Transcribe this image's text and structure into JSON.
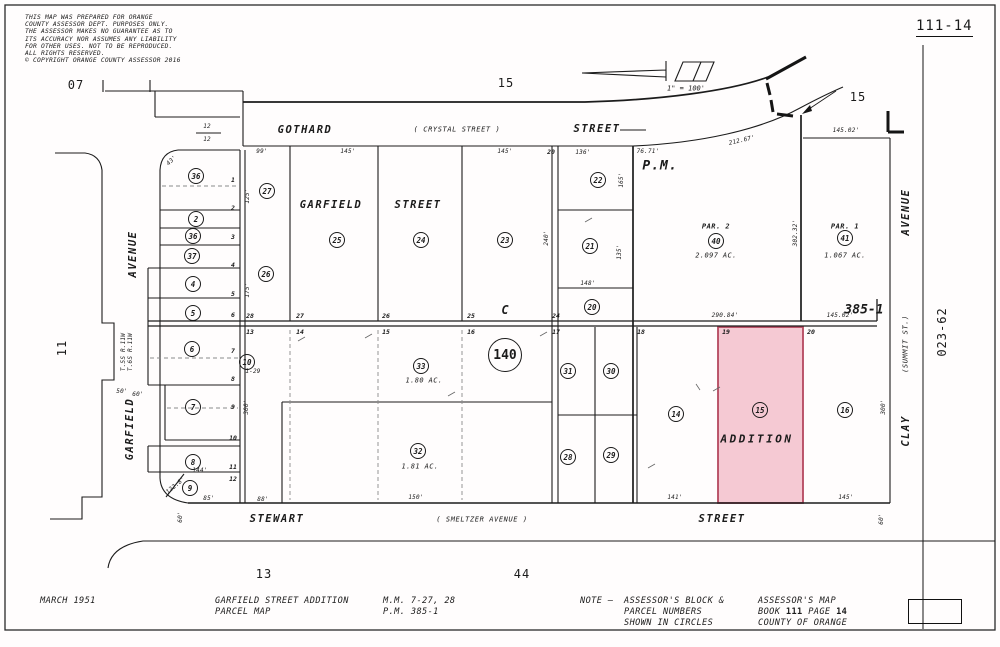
{
  "page": {
    "map_ref": "111-14",
    "disclaimer_lines": [
      "THIS MAP WAS PREPARED FOR ORANGE",
      "COUNTY ASSESSOR DEPT. PURPOSES ONLY.",
      "THE ASSESSOR MAKES NO GUARANTEE AS TO",
      "ITS ACCURACY NOR ASSUMES ANY LIABILITY",
      "FOR OTHER USES.  NOT TO BE REPRODUCED.",
      "ALL RIGHTS RESERVED.",
      "© COPYRIGHT ORANGE COUNTY ASSESSOR 2016"
    ]
  },
  "footer": {
    "date": "MARCH 1951",
    "title_line1": "GARFIELD STREET ADDITION",
    "title_line2": "PARCEL MAP",
    "ref_line1": "M.M. 7-27, 28",
    "ref_line2": "P.M. 385-1",
    "note_prefix": "NOTE —",
    "note_line1": "ASSESSOR'S BLOCK &",
    "note_line2": "PARCEL NUMBERS",
    "note_line3": "SHOWN IN CIRCLES",
    "assessor_line1": "ASSESSOR'S MAP",
    "book_label": "BOOK",
    "book_number": "111",
    "page_label": "PAGE",
    "page_number": "14",
    "assessor_line3": "COUNTY OF ORANGE"
  },
  "map": {
    "highlight": {
      "parcel": "15",
      "fill": "#f5c9d3",
      "stroke": "#b5485e"
    },
    "scale_note": "1\" = 100'",
    "labels": [
      {
        "t": "GOTHARD",
        "x": 305,
        "y": 130,
        "k": "street"
      },
      {
        "t": "( CRYSTAL STREET )",
        "x": 457,
        "y": 130,
        "k": "ssub"
      },
      {
        "t": "STREET",
        "x": 597,
        "y": 129,
        "k": "street"
      },
      {
        "t": "GARFIELD",
        "x": 331,
        "y": 205,
        "k": "street"
      },
      {
        "t": "STREET",
        "x": 418,
        "y": 205,
        "k": "street"
      },
      {
        "t": "AVENUE",
        "x": 133,
        "y": 254,
        "k": "street",
        "r": -90
      },
      {
        "t": "GARFIELD",
        "x": 130,
        "y": 429,
        "k": "street",
        "r": -90
      },
      {
        "t": "STEWART",
        "x": 277,
        "y": 519,
        "k": "street"
      },
      {
        "t": "( SMELTZER AVENUE )",
        "x": 482,
        "y": 520,
        "k": "ssub"
      },
      {
        "t": "STREET",
        "x": 722,
        "y": 519,
        "k": "street"
      },
      {
        "t": "AVENUE",
        "x": 906,
        "y": 212,
        "k": "street",
        "r": -90
      },
      {
        "t": "(SUMMIT ST.)",
        "x": 906,
        "y": 344,
        "k": "ssub",
        "r": -90
      },
      {
        "t": "CLAY",
        "x": 906,
        "y": 431,
        "k": "street",
        "r": -90
      },
      {
        "t": "P.M.",
        "x": 660,
        "y": 166,
        "k": "pm"
      },
      {
        "t": "C",
        "x": 505,
        "y": 310,
        "k": "blk"
      },
      {
        "t": "ADDITION",
        "x": 757,
        "y": 439,
        "k": "add"
      },
      {
        "t": "385-1",
        "x": 864,
        "y": 310,
        "k": "ref"
      },
      {
        "t": "PAR. 2",
        "x": 716,
        "y": 227,
        "k": "par"
      },
      {
        "t": "2.097 AC.",
        "x": 716,
        "y": 256,
        "k": "acr"
      },
      {
        "t": "PAR. 1",
        "x": 845,
        "y": 227,
        "k": "par"
      },
      {
        "t": "1.067 AC.",
        "x": 845,
        "y": 256,
        "k": "acr"
      },
      {
        "t": "1.80 AC.",
        "x": 424,
        "y": 381,
        "k": "acr"
      },
      {
        "t": "1.81 AC.",
        "x": 420,
        "y": 467,
        "k": "acr"
      },
      {
        "t": "1\" = 100'",
        "x": 686,
        "y": 89,
        "k": "scale"
      },
      {
        "t": "07",
        "x": 76,
        "y": 85,
        "k": "page"
      },
      {
        "t": "15",
        "x": 506,
        "y": 83,
        "k": "page"
      },
      {
        "t": "15",
        "x": 858,
        "y": 97,
        "k": "page"
      },
      {
        "t": "11",
        "x": 62,
        "y": 348,
        "k": "page",
        "r": -90
      },
      {
        "t": "13",
        "x": 264,
        "y": 574,
        "k": "page"
      },
      {
        "t": "44",
        "x": 522,
        "y": 574,
        "k": "page"
      },
      {
        "t": "023-62",
        "x": 942,
        "y": 332,
        "k": "page",
        "r": -90
      },
      {
        "t": "28",
        "x": 250,
        "y": 316,
        "k": "lot"
      },
      {
        "t": "27",
        "x": 300,
        "y": 316,
        "k": "lot"
      },
      {
        "t": "26",
        "x": 386,
        "y": 316,
        "k": "lot"
      },
      {
        "t": "25",
        "x": 471,
        "y": 316,
        "k": "lot"
      },
      {
        "t": "24",
        "x": 556,
        "y": 316,
        "k": "lot"
      },
      {
        "t": "13",
        "x": 250,
        "y": 332,
        "k": "lot"
      },
      {
        "t": "14",
        "x": 300,
        "y": 332,
        "k": "lot"
      },
      {
        "t": "15",
        "x": 386,
        "y": 332,
        "k": "lot"
      },
      {
        "t": "16",
        "x": 471,
        "y": 332,
        "k": "lot"
      },
      {
        "t": "17",
        "x": 556,
        "y": 332,
        "k": "lot"
      },
      {
        "t": "18",
        "x": 641,
        "y": 332,
        "k": "lot"
      },
      {
        "t": "19",
        "x": 726,
        "y": 332,
        "k": "lot"
      },
      {
        "t": "20",
        "x": 811,
        "y": 332,
        "k": "lot"
      },
      {
        "t": "1",
        "x": 233,
        "y": 180,
        "k": "lot"
      },
      {
        "t": "2",
        "x": 233,
        "y": 208,
        "k": "lot"
      },
      {
        "t": "3",
        "x": 233,
        "y": 237,
        "k": "lot"
      },
      {
        "t": "4",
        "x": 233,
        "y": 265,
        "k": "lot"
      },
      {
        "t": "5",
        "x": 233,
        "y": 294,
        "k": "lot"
      },
      {
        "t": "6",
        "x": 233,
        "y": 315,
        "k": "lot"
      },
      {
        "t": "7",
        "x": 233,
        "y": 351,
        "k": "lot"
      },
      {
        "t": "8",
        "x": 233,
        "y": 379,
        "k": "lot"
      },
      {
        "t": "9",
        "x": 233,
        "y": 407,
        "k": "lot"
      },
      {
        "t": "10",
        "x": 233,
        "y": 438,
        "k": "lot"
      },
      {
        "t": "11",
        "x": 233,
        "y": 467,
        "k": "lot"
      },
      {
        "t": "12",
        "x": 233,
        "y": 479,
        "k": "lot"
      },
      {
        "t": "20",
        "x": 551,
        "y": 152,
        "k": "lot"
      },
      {
        "t": "99'",
        "x": 262,
        "y": 152,
        "k": "dim"
      },
      {
        "t": "145'",
        "x": 348,
        "y": 152,
        "k": "dim"
      },
      {
        "t": "145'",
        "x": 505,
        "y": 152,
        "k": "dim"
      },
      {
        "t": "136'",
        "x": 583,
        "y": 153,
        "k": "dim"
      },
      {
        "t": "43'",
        "x": 172,
        "y": 161,
        "k": "dim",
        "r": -45
      },
      {
        "t": "125'",
        "x": 248,
        "y": 196,
        "k": "dim",
        "r": -90
      },
      {
        "t": "175'",
        "x": 248,
        "y": 290,
        "k": "dim",
        "r": -90
      },
      {
        "t": "300'",
        "x": 247,
        "y": 407,
        "k": "dim",
        "r": -90
      },
      {
        "t": "50'",
        "x": 122,
        "y": 392,
        "k": "dim"
      },
      {
        "t": "60'",
        "x": 138,
        "y": 395,
        "k": "dim"
      },
      {
        "t": "T.5S R.11W",
        "x": 124,
        "y": 352,
        "k": "dim",
        "r": -90
      },
      {
        "t": "T.6S R.11W",
        "x": 131,
        "y": 352,
        "k": "dim",
        "r": -90
      },
      {
        "t": "144'",
        "x": 200,
        "y": 471,
        "k": "dim"
      },
      {
        "t": "85'",
        "x": 209,
        "y": 499,
        "k": "dim"
      },
      {
        "t": "88'",
        "x": 263,
        "y": 500,
        "k": "dim"
      },
      {
        "t": "122.8'",
        "x": 176,
        "y": 486,
        "k": "dim",
        "r": -40
      },
      {
        "t": "60'",
        "x": 181,
        "y": 517,
        "k": "dim",
        "r": -90
      },
      {
        "t": "1-29",
        "x": 253,
        "y": 372,
        "k": "dim"
      },
      {
        "t": "148'",
        "x": 588,
        "y": 284,
        "k": "dim"
      },
      {
        "t": "240'",
        "x": 547,
        "y": 238,
        "k": "dim",
        "r": -90
      },
      {
        "t": "165'",
        "x": 622,
        "y": 180,
        "k": "dim",
        "r": -90
      },
      {
        "t": "135'",
        "x": 620,
        "y": 252,
        "k": "dim",
        "r": -90
      },
      {
        "t": "76.71'",
        "x": 648,
        "y": 152,
        "k": "dim"
      },
      {
        "t": "212.67'",
        "x": 742,
        "y": 141,
        "k": "dim",
        "r": -13
      },
      {
        "t": "145.02'",
        "x": 846,
        "y": 131,
        "k": "dim"
      },
      {
        "t": "290.84'",
        "x": 725,
        "y": 316,
        "k": "dim"
      },
      {
        "t": "145.02'",
        "x": 840,
        "y": 316,
        "k": "dim"
      },
      {
        "t": "302.32'",
        "x": 796,
        "y": 233,
        "k": "dim",
        "r": -90
      },
      {
        "t": "300'",
        "x": 884,
        "y": 407,
        "k": "dim",
        "r": -90
      },
      {
        "t": "150'",
        "x": 416,
        "y": 498,
        "k": "dim"
      },
      {
        "t": "141'",
        "x": 675,
        "y": 498,
        "k": "dim"
      },
      {
        "t": "145'",
        "x": 846,
        "y": 498,
        "k": "dim"
      },
      {
        "t": "60'",
        "x": 882,
        "y": 519,
        "k": "dim",
        "r": -90
      },
      {
        "t": "12",
        "x": 207,
        "y": 127,
        "k": "dim"
      },
      {
        "t": "12",
        "x": 207,
        "y": 140,
        "k": "dim"
      }
    ],
    "parcel_circles": [
      {
        "n": "36",
        "x": 196,
        "y": 176
      },
      {
        "n": "2",
        "x": 196,
        "y": 219
      },
      {
        "n": "36",
        "x": 193,
        "y": 236
      },
      {
        "n": "37",
        "x": 192,
        "y": 256
      },
      {
        "n": "4",
        "x": 193,
        "y": 284
      },
      {
        "n": "5",
        "x": 193,
        "y": 313
      },
      {
        "n": "6",
        "x": 192,
        "y": 349
      },
      {
        "n": "10",
        "x": 247,
        "y": 362
      },
      {
        "n": "7",
        "x": 193,
        "y": 407
      },
      {
        "n": "8",
        "x": 193,
        "y": 462
      },
      {
        "n": "9",
        "x": 190,
        "y": 488
      },
      {
        "n": "27",
        "x": 267,
        "y": 191
      },
      {
        "n": "26",
        "x": 266,
        "y": 274
      },
      {
        "n": "25",
        "x": 337,
        "y": 240
      },
      {
        "n": "24",
        "x": 421,
        "y": 240
      },
      {
        "n": "23",
        "x": 505,
        "y": 240
      },
      {
        "n": "22",
        "x": 598,
        "y": 180
      },
      {
        "n": "21",
        "x": 590,
        "y": 246
      },
      {
        "n": "20",
        "x": 592,
        "y": 307
      },
      {
        "n": "33",
        "x": 421,
        "y": 366
      },
      {
        "n": "32",
        "x": 418,
        "y": 451
      },
      {
        "n": "31",
        "x": 568,
        "y": 371
      },
      {
        "n": "30",
        "x": 611,
        "y": 371
      },
      {
        "n": "28",
        "x": 568,
        "y": 457
      },
      {
        "n": "29",
        "x": 611,
        "y": 455
      },
      {
        "n": "14",
        "x": 676,
        "y": 414
      },
      {
        "n": "15",
        "x": 760,
        "y": 410
      },
      {
        "n": "16",
        "x": 845,
        "y": 410
      },
      {
        "n": "40",
        "x": 716,
        "y": 241
      },
      {
        "n": "41",
        "x": 845,
        "y": 238
      },
      {
        "n": "140",
        "x": 505,
        "y": 355,
        "big": true
      }
    ]
  }
}
